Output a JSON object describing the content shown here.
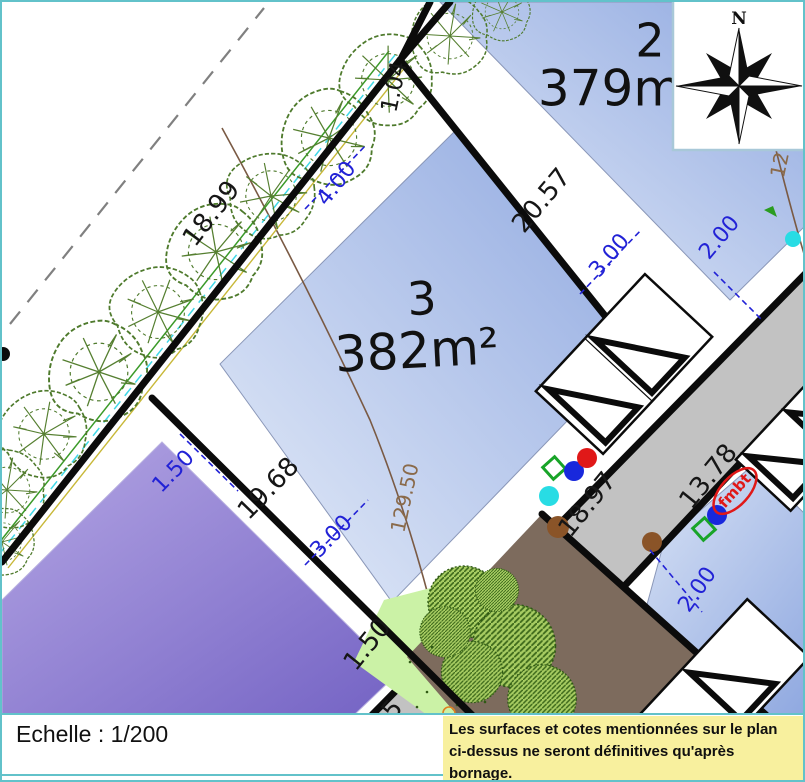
{
  "page": {
    "scale_text": "Echelle :  1/200",
    "note_line1": "Les surfaces et cotes mentionnées sur le plan",
    "note_line2": "ci-dessus ne seront définitives qu'après bornage."
  },
  "compass": {
    "north_label": "N"
  },
  "parcels": [
    {
      "number": "2",
      "area": "379m²"
    },
    {
      "number": "3",
      "area": "382m²"
    }
  ],
  "map_labels": [
    {
      "text": "1.04",
      "x": 393,
      "y": 85,
      "rot": -78,
      "cls": "black",
      "size": 23
    },
    {
      "text": "18.99",
      "x": 210,
      "y": 212,
      "rot": -52,
      "cls": "black",
      "size": 26
    },
    {
      "text": "4.00",
      "x": 335,
      "y": 182,
      "rot": -52,
      "cls": "blue",
      "size": 22
    },
    {
      "text": "20.57",
      "x": 540,
      "y": 199,
      "rot": -50,
      "cls": "black",
      "size": 26
    },
    {
      "text": "3.00",
      "x": 608,
      "y": 254,
      "rot": -50,
      "cls": "blue",
      "size": 22
    },
    {
      "text": "2.00",
      "x": 718,
      "y": 236,
      "rot": -50,
      "cls": "blue",
      "size": 22
    },
    {
      "text": "12",
      "x": 779,
      "y": 163,
      "rot": -78,
      "cls": "contour",
      "size": 20
    },
    {
      "text": "129.50",
      "x": 404,
      "y": 496,
      "rot": -78,
      "cls": "contour",
      "size": 20
    },
    {
      "text": "19.68",
      "x": 267,
      "y": 487,
      "rot": -46,
      "cls": "black",
      "size": 26
    },
    {
      "text": "3.00",
      "x": 330,
      "y": 535,
      "rot": -46,
      "cls": "blue",
      "size": 22
    },
    {
      "text": "1.50",
      "x": 172,
      "y": 470,
      "rot": -46,
      "cls": "blue",
      "size": 22
    },
    {
      "text": "1.50",
      "x": 366,
      "y": 643,
      "rot": -51,
      "cls": "black",
      "size": 26
    },
    {
      "text": "5",
      "x": 391,
      "y": 708,
      "rot": -51,
      "cls": "black",
      "size": 26
    },
    {
      "text": "18.97",
      "x": 586,
      "y": 503,
      "rot": -51,
      "cls": "black",
      "size": 26
    },
    {
      "text": "13.78",
      "x": 707,
      "y": 475,
      "rot": -51,
      "cls": "black",
      "size": 26
    },
    {
      "text": "2.00",
      "x": 696,
      "y": 588,
      "rot": -55,
      "cls": "blue",
      "size": 22
    },
    {
      "text": "fmbt",
      "x": 733,
      "y": 489,
      "rot": -48,
      "cls": "red",
      "size": 15
    },
    {
      "text": "3",
      "x": 420,
      "y": 300,
      "rot": -3,
      "cls": "parcel",
      "size": 46
    },
    {
      "text": "382m²",
      "x": 415,
      "y": 352,
      "rot": -3,
      "cls": "parcel",
      "size": 50
    },
    {
      "text": "2",
      "x": 648,
      "y": 42,
      "rot": 0,
      "cls": "parcel",
      "size": 46
    },
    {
      "text": "379m²",
      "x": 618,
      "y": 90,
      "rot": 0,
      "cls": "parcel",
      "size": 50
    }
  ],
  "colors": {
    "parcel_blue_dark": "#8fa8e0",
    "parcel_blue_light": "#e6edf9",
    "purple_dark": "#7463c4",
    "purple_light": "#b4a6e4",
    "road_gray": "#c2c2c2",
    "soil_brown": "#7d6b5d",
    "grass_green": "#cbf2a6",
    "dim_blue": "#2222d6",
    "contour_brown": "#8a6a4a",
    "teal_border": "#62c2ca",
    "note_yellow": "#f8f09e",
    "marker_red": "#e01818",
    "marker_cyan": "#28dce4",
    "marker_blue": "#1828dc",
    "marker_green": "#18a428",
    "marker_brown": "#8a5428"
  }
}
